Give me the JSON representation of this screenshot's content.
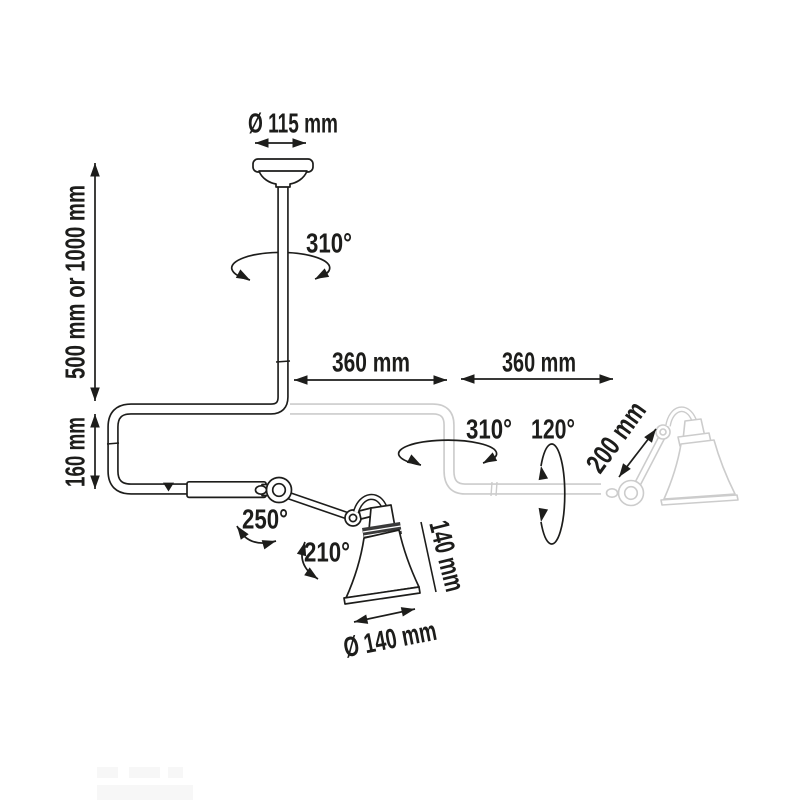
{
  "page": {
    "background": "#ffffff"
  },
  "diagram": {
    "type": "product-dimension-diagram",
    "subject": "articulated-ceiling-lamp",
    "colors": {
      "ink": "#1d1d1b",
      "ghost": "#cccccc",
      "background": "#ffffff"
    },
    "labels": {
      "canopy_diameter": "Ø 115 mm",
      "drop_length": "500 mm or 1000 mm",
      "elbow_drop": "160 mm",
      "bar_segment_1": "360 mm",
      "bar_segment_2": "360 mm",
      "stem_rotation": "310°",
      "bar_rotation": "310°",
      "arm_swivel": "120°",
      "arm_length": "200 mm",
      "elbow_rotation": "250°",
      "shade_joint_rotation": "210°",
      "shade_height": "140 mm",
      "shade_diameter": "Ø 140 mm"
    }
  }
}
